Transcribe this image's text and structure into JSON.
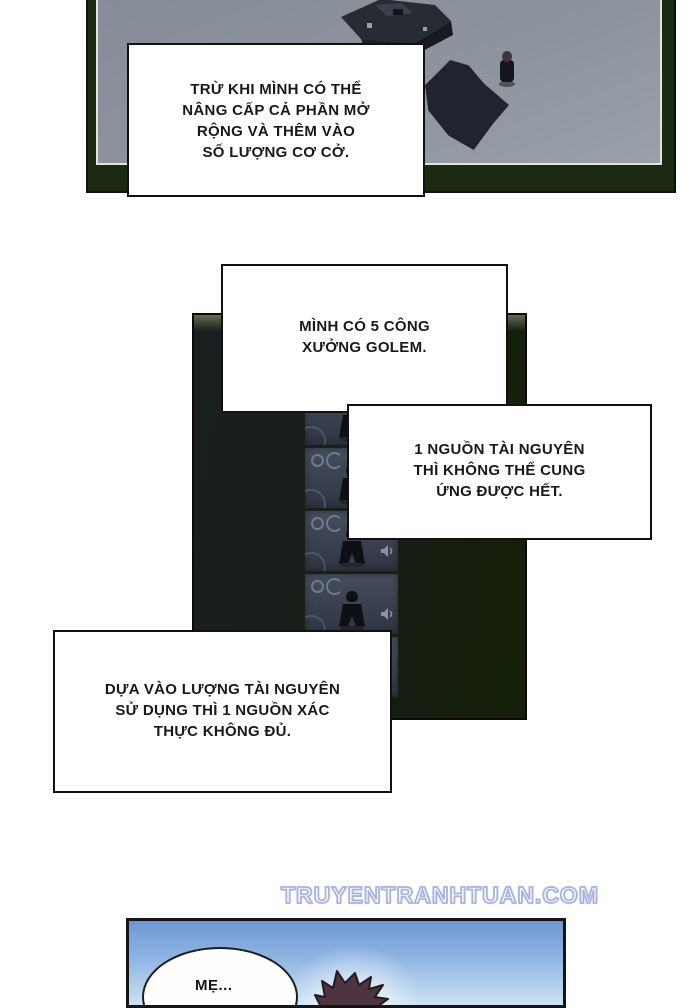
{
  "page_type": "manhwa-comic-page",
  "watermark": {
    "text": "TRUYENTRANHTUAN.COM",
    "color": "#a9b2e2"
  },
  "speech_boxes": [
    {
      "lines": [
        "TRỪ KHI MÌNH CÓ THỂ",
        "NÂNG CẤP CẢ PHẦN MỞ",
        "RỘNG VÀ THÊM VÀO",
        "SỐ LƯỢNG CƠ CỞ."
      ]
    },
    {
      "lines": [
        "MÌNH CÓ 5 CÔNG",
        "XƯỞNG GOLEM."
      ]
    },
    {
      "lines": [
        "1 NGUỒN TÀI NGUYÊN",
        "THÌ KHÔNG THỂ CUNG",
        "ỨNG ĐƯỢC HẾT."
      ]
    },
    {
      "lines": [
        "DỰA VÀO LƯỢNG TÀI NGUYÊN",
        "SỬ DỤNG THÌ 1 NGUỒN XÁC",
        "THỰC KHÔNG ĐỦ."
      ]
    }
  ],
  "panels": {
    "village_overview": {
      "frame_color": "#1b2a11",
      "ground_color": "#8d949e"
    },
    "golem_factory": {
      "background_color": "#171d15",
      "slot_count": 5
    },
    "bottom_scene": {
      "sky_top_color": "#6f96d4",
      "sky_bottom_color": "#cbe2f2",
      "bubble_text": "MẸ..."
    }
  },
  "icons": {
    "ring": "circle-outline",
    "gear_ring": "open-circle",
    "golem_figure": "dark-silhouette",
    "speaker": "volume-glyph",
    "alert_head": "red-oval"
  }
}
